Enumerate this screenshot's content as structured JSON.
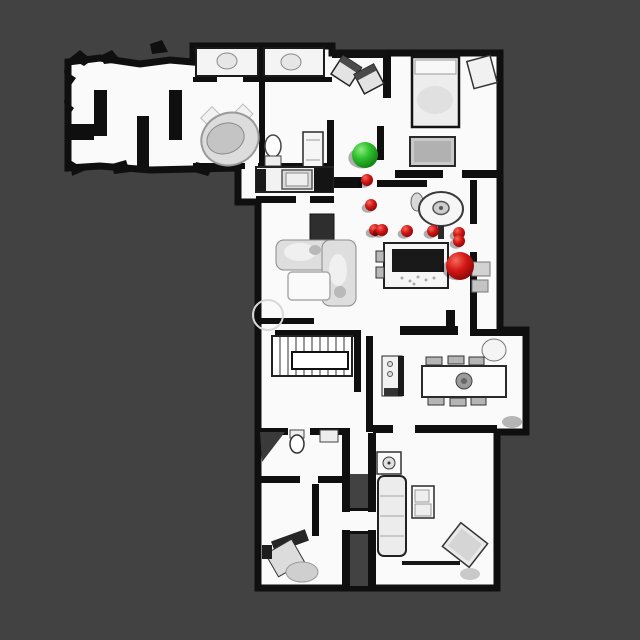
{
  "scene": {
    "background_color": "#424242",
    "floor_color": "#fafafa",
    "wall_color": "#0f0f0f",
    "furniture_color": "#e3e3e3"
  },
  "markers": {
    "start": {
      "name": "start-marker",
      "color": "#2ec22e",
      "x": 365,
      "y": 155,
      "r": 13
    },
    "goal": {
      "name": "goal-marker",
      "color": "#d41616",
      "x": 460,
      "y": 266,
      "r": 14
    },
    "waypoint_color": "#d41616",
    "waypoints": [
      {
        "x": 367,
        "y": 180,
        "r": 6
      },
      {
        "x": 371,
        "y": 205,
        "r": 6
      },
      {
        "x": 375,
        "y": 230,
        "r": 6
      },
      {
        "x": 382,
        "y": 230,
        "r": 6
      },
      {
        "x": 407,
        "y": 231,
        "r": 6
      },
      {
        "x": 433,
        "y": 231,
        "r": 6
      },
      {
        "x": 459,
        "y": 233,
        "r": 6
      },
      {
        "x": 459,
        "y": 241,
        "r": 6
      }
    ]
  }
}
